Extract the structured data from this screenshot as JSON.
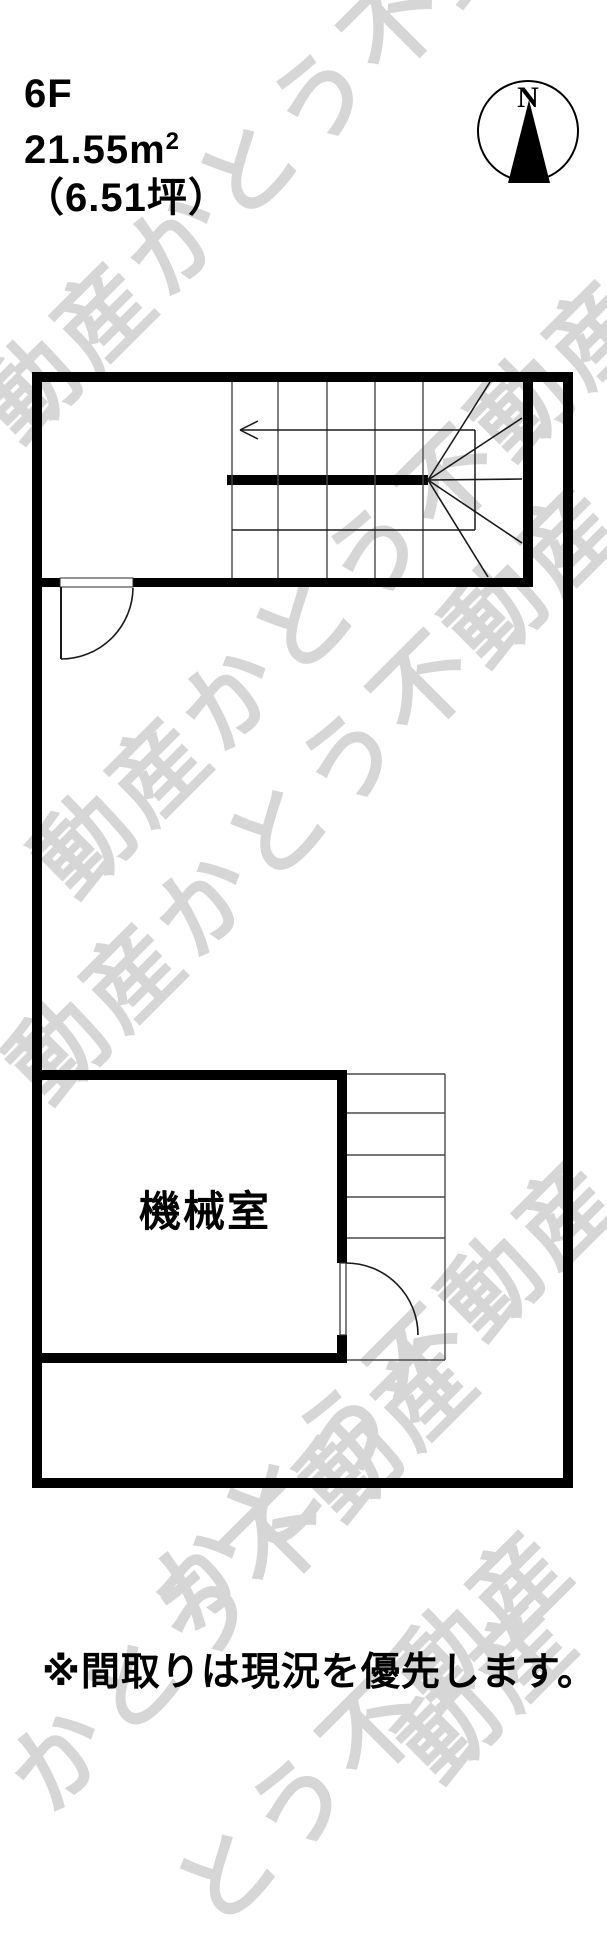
{
  "header": {
    "floor": "6F",
    "area_sqm_value": "21.55m",
    "area_sqm_sup": "2",
    "area_tsubo": "（6.51坪）"
  },
  "compass": {
    "north_label": "N"
  },
  "plan": {
    "room_label": "機械室",
    "stair_arrow_direction": "left-up"
  },
  "footnote": "※間取りは現況を優先します。",
  "watermark": {
    "text": "かとう不動産",
    "color": "#d6d6d6",
    "strips": [
      "動産かとう不動産",
      "動産かとう不動産",
      "動産かとう不動産",
      "かとう不動産",
      "かとう不動産",
      "とう不動産",
      "動産"
    ]
  },
  "colors": {
    "background": "#ffffff",
    "wall": "#000000",
    "tread_line": "#4a4a4a",
    "door_line": "#1a1a1a",
    "watermark": "#d6d6d6"
  }
}
